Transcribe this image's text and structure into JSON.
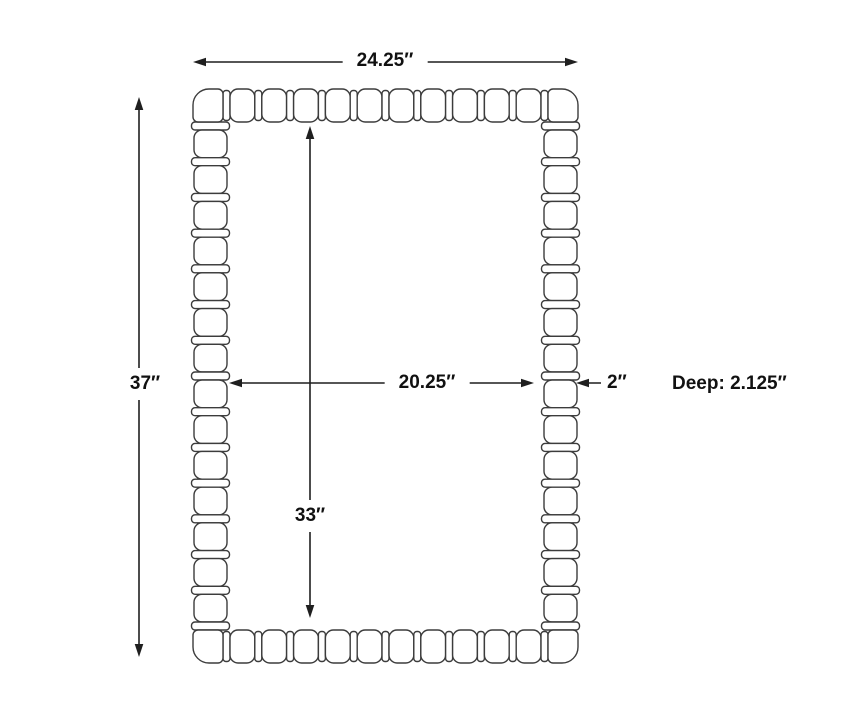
{
  "diagram": {
    "labels": {
      "width": "24.25″",
      "height": "37″",
      "inner_width": "20.25″",
      "inner_height": "33″",
      "frame_thickness": "2″",
      "depth": "Deep: 2.125″"
    },
    "colors": {
      "bead_outline": "#3c3c3c",
      "dimension_line": "#1f1f1f",
      "text": "#111111",
      "background": "#ffffff"
    }
  }
}
